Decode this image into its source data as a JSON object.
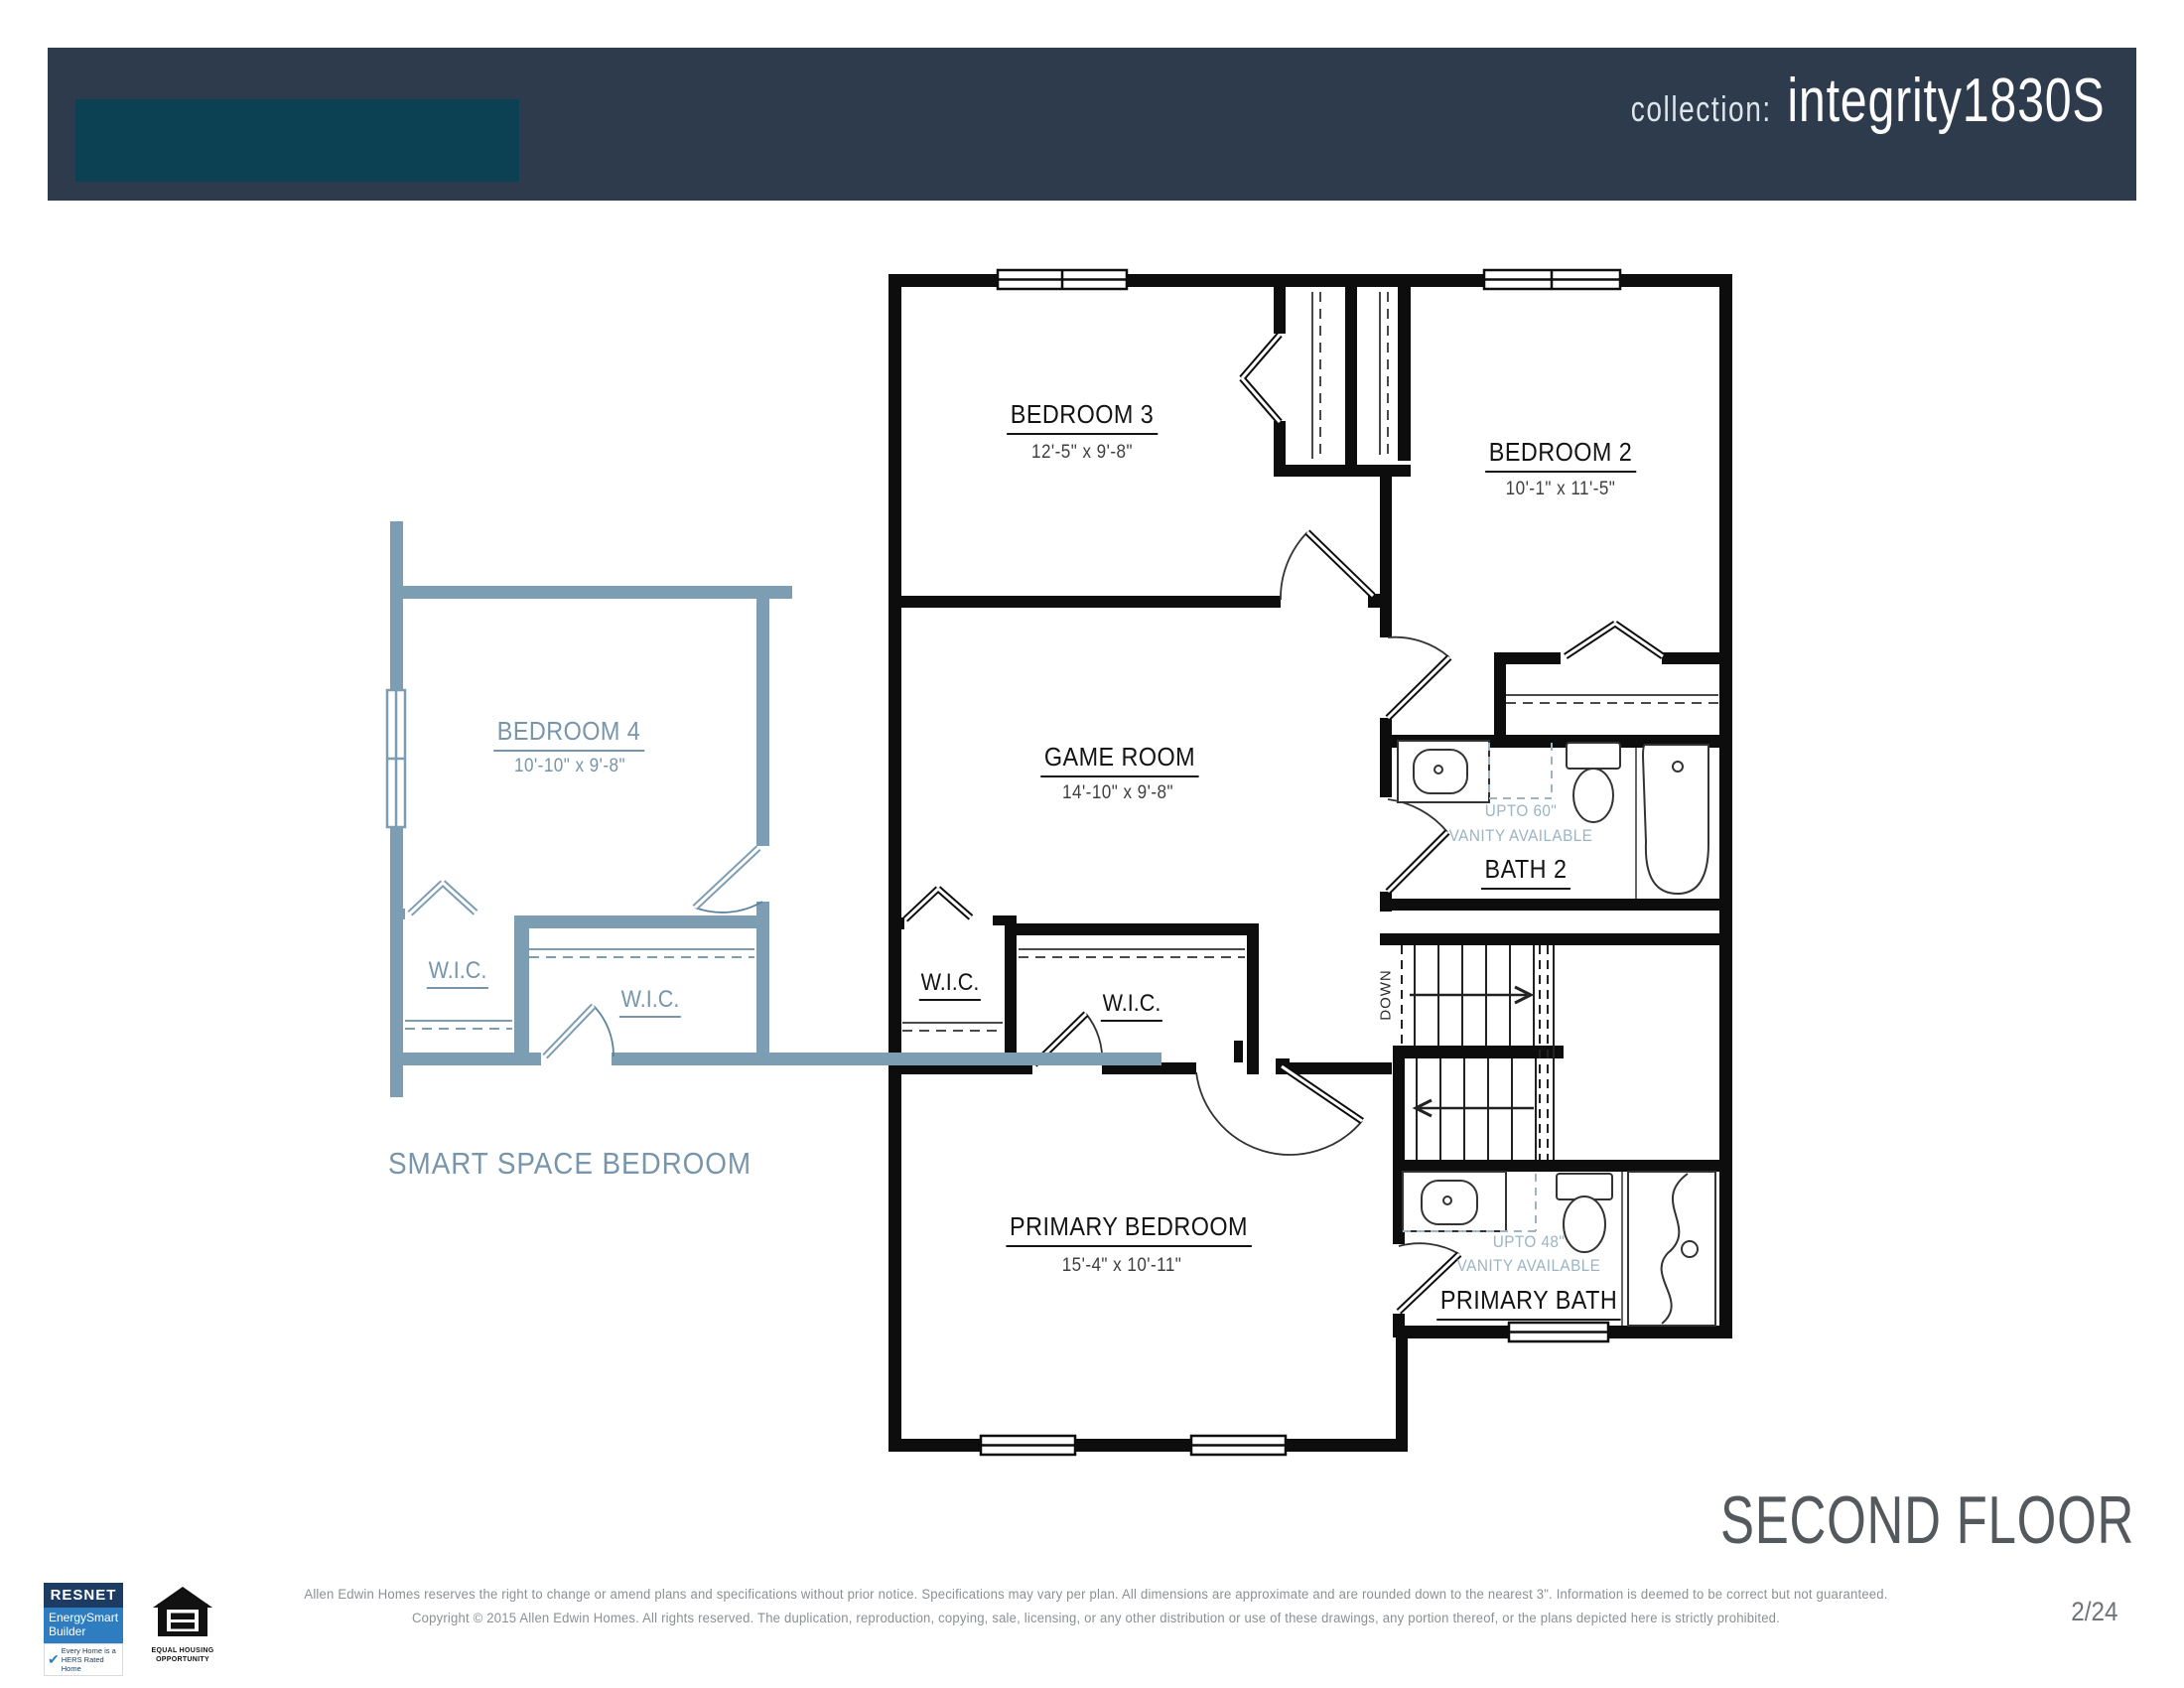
{
  "header": {
    "collection_label": "collection:",
    "plan_name": "integrity1830S"
  },
  "colors": {
    "header_bar": "#2d3b4d",
    "header_accent": "#0b4152",
    "smart_plan_blue": "#7d9db2",
    "plan_label_blue": "#7795ab",
    "vanity_note_blue": "#9cb4c3",
    "main_plan_black": "#000000",
    "floor_title_gray": "#54595d"
  },
  "main_plan": {
    "bedroom3": {
      "name": "BEDROOM 3",
      "dims": "12'-5\" x 9'-8\""
    },
    "bedroom2": {
      "name": "BEDROOM 2",
      "dims": "10'-1\" x 11'-5\""
    },
    "game_room": {
      "name": "GAME ROOM",
      "dims": "14'-10\" x 9'-8\""
    },
    "bath2": {
      "name": "BATH 2",
      "vanity_note_line1": "UPTO 60\"",
      "vanity_note_line2": "VANITY AVAILABLE"
    },
    "wic_left": {
      "name": "W.I.C."
    },
    "wic_center": {
      "name": "W.I.C."
    },
    "primary_bedroom": {
      "name": "PRIMARY BEDROOM",
      "dims": "15'-4\" x 10'-11\""
    },
    "primary_bath": {
      "name": "PRIMARY BATH",
      "vanity_note_line1": "UPTO 48\"",
      "vanity_note_line2": "VANITY AVAILABLE"
    },
    "stairs_label": "DOWN"
  },
  "smart_space": {
    "title": "SMART SPACE BEDROOM",
    "bedroom4": {
      "name": "BEDROOM 4",
      "dims": "10'-10\" x 9'-8\""
    },
    "wic_left": {
      "name": "W.I.C."
    },
    "wic_right": {
      "name": "W.I.C."
    }
  },
  "floor_title": "SECOND FLOOR",
  "footer": {
    "disclaimer_line1": "Allen Edwin Homes reserves the right to change or amend plans and specifications without prior notice. Specifications may vary per plan. All dimensions are approximate and are rounded down to the nearest 3\". Information is deemed to be correct but not guaranteed.",
    "disclaimer_line2": "Copyright © 2015 Allen Edwin Homes. All rights reserved. The duplication, reproduction, copying, sale, licensing, or any other distribution or use of these drawings, any portion thereof, or the plans depicted here is strictly prohibited.",
    "page_number": "2/24",
    "resnet": {
      "title": "RESNET",
      "line1": "EnergySmart",
      "line2": "Builder",
      "check": "✔",
      "tagline1": "Every Home is a",
      "tagline2": "HERS Rated Home"
    },
    "equal_housing": {
      "line1": "EQUAL HOUSING",
      "line2": "OPPORTUNITY"
    }
  }
}
